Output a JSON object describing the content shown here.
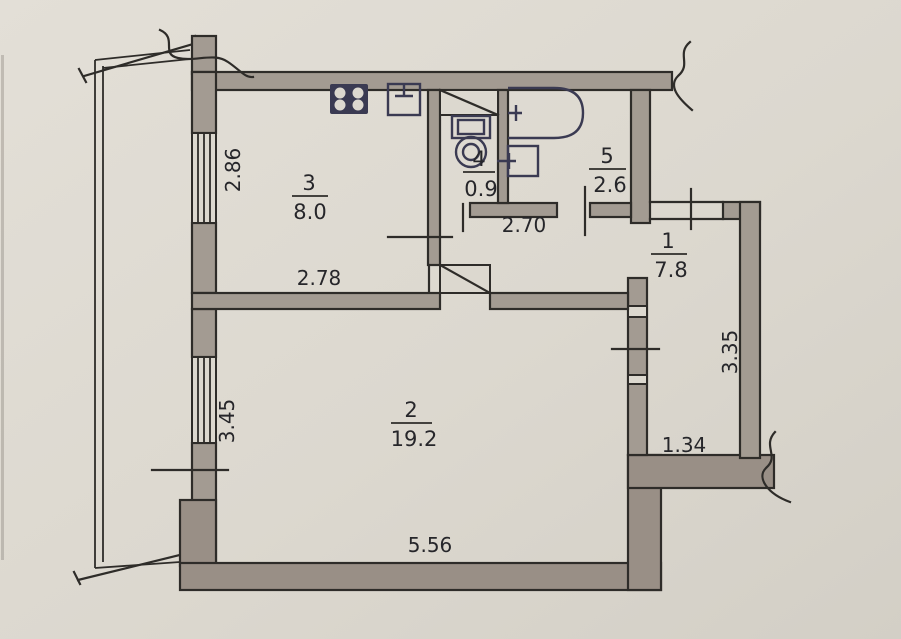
{
  "title": "Apartment floor plan (BTI drawing)",
  "colors": {
    "paper": "#dcd8cf",
    "wall": "#a39b92",
    "wall2": "#998f86",
    "line": "#2e2c29",
    "fixture": "#3a3a52",
    "text": "#26262a"
  },
  "rooms": [
    {
      "number": "1",
      "area": "7.8",
      "kind": "hallway"
    },
    {
      "number": "2",
      "area": "19.2",
      "kind": "living-room"
    },
    {
      "number": "3",
      "area": "8.0",
      "kind": "kitchen"
    },
    {
      "number": "4",
      "area": "0.9",
      "kind": "wc"
    },
    {
      "number": "5",
      "area": "2.6",
      "kind": "bathroom"
    }
  ],
  "dimensions": {
    "room3_window": "2.86",
    "room3_width": "2.78",
    "corridor_width": "2.70",
    "room2_window": "3.45",
    "room1_depth": "3.35",
    "room1_width": "1.34",
    "room2_width": "5.56"
  },
  "fixtures": [
    "stove-icon",
    "kitchen-sink-icon",
    "toilet-icon",
    "bathtub-icon",
    "washbasin-icon",
    "vent-shaft",
    "door-leaf"
  ]
}
